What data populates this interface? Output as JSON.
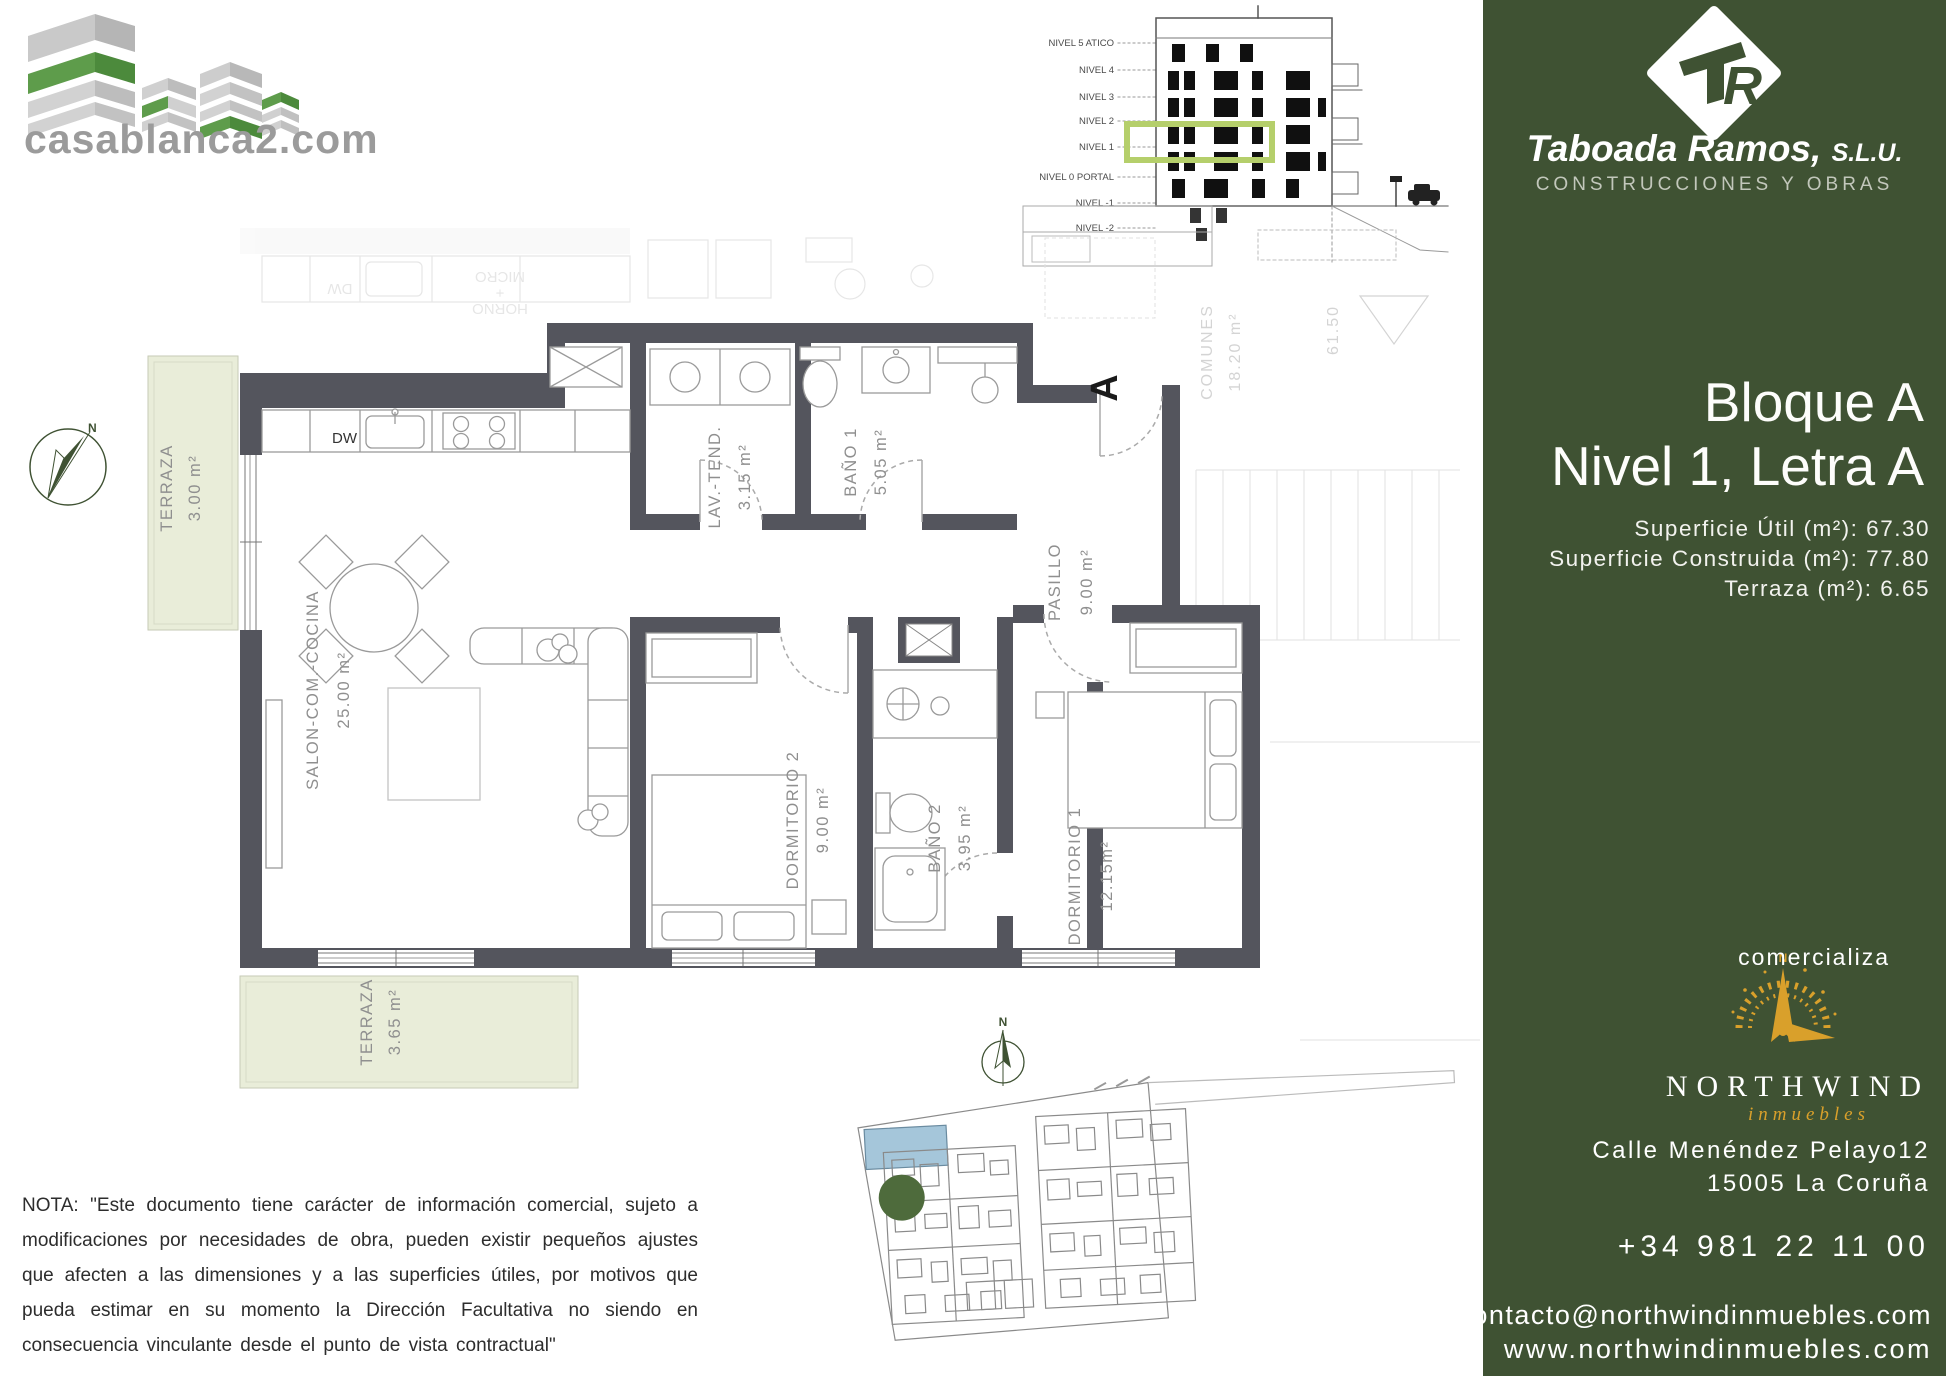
{
  "colors": {
    "sidebar_green": "#3F5233",
    "logo_green": "#5E9C4B",
    "highlight_green": "#B5CF6B",
    "terrace_fill": "#E9EDD9",
    "wall_gray": "#54555D",
    "gold": "#D9A02B",
    "pool_blue": "#A5C6DA",
    "marker_green": "#4E6B3C"
  },
  "brand": {
    "logo_text": "casablanca2.com"
  },
  "builder": {
    "name": "Taboada Ramos,",
    "suffix": "S.L.U.",
    "tagline": "CONSTRUCCIONES Y OBRAS"
  },
  "elevation": {
    "levels": [
      "NIVEL 5 ATICO",
      "NIVEL 4",
      "NIVEL 3",
      "NIVEL 2",
      "NIVEL 1",
      "NIVEL 0 PORTAL",
      "NIVEL -1",
      "NIVEL -2"
    ]
  },
  "unit": {
    "line1": "Bloque A",
    "line2": "Nivel 1, Letra A",
    "areas": [
      "Superficie Útil (m²): 67.30",
      "Superficie Construida (m²): 77.80",
      "Terraza (m²):  6.65"
    ]
  },
  "plan": {
    "entrance": "A",
    "dw": "DW",
    "north": "N",
    "rooms": [
      {
        "name": "TERRAZA",
        "area": "3.00 m²"
      },
      {
        "name": "SALON-COM.-COCINA",
        "area": "25.00 m²"
      },
      {
        "name": "LAV.-TEND.",
        "area": "3.15 m²"
      },
      {
        "name": "BAÑO 1",
        "area": "5.05 m²"
      },
      {
        "name": "PASILLO",
        "area": "9.00 m²"
      },
      {
        "name": "DORMITORIO 2",
        "area": "9.00 m²"
      },
      {
        "name": "BAÑO 2",
        "area": "3.95 m²"
      },
      {
        "name": "DORMITORIO 1",
        "area": "12.15m²"
      },
      {
        "name": "TERRAZA",
        "area": "3.65 m²"
      }
    ],
    "faded": {
      "dw": "DW",
      "micro": "MICRO",
      "plus": "+",
      "horno": "HORNO",
      "comunes": "COMUNES",
      "comunes_area": "18.20 m²",
      "level": "61.50"
    }
  },
  "agency": {
    "intro": "comercializa",
    "name": "NORTHWIND",
    "tag": "inmuebles",
    "compass_n": "N",
    "address1": "Calle Menéndez Pelayo12",
    "address2": "15005 La Coruña",
    "phone": "+34 981 22 11 00",
    "email": "contacto@northwindinmuebles.com",
    "web": "www.northwindinmuebles.com"
  },
  "note": "NOTA: \"Este documento tiene carácter de información comercial, sujeto a modificaciones por necesidades de obra, pueden existir pequeños ajustes que afecten a las dimensiones y a las superficies útiles, por motivos que pueda estimar en su momento la Dirección Facultativa no siendo en consecuencia vinculante desde el punto de vista contractual\""
}
